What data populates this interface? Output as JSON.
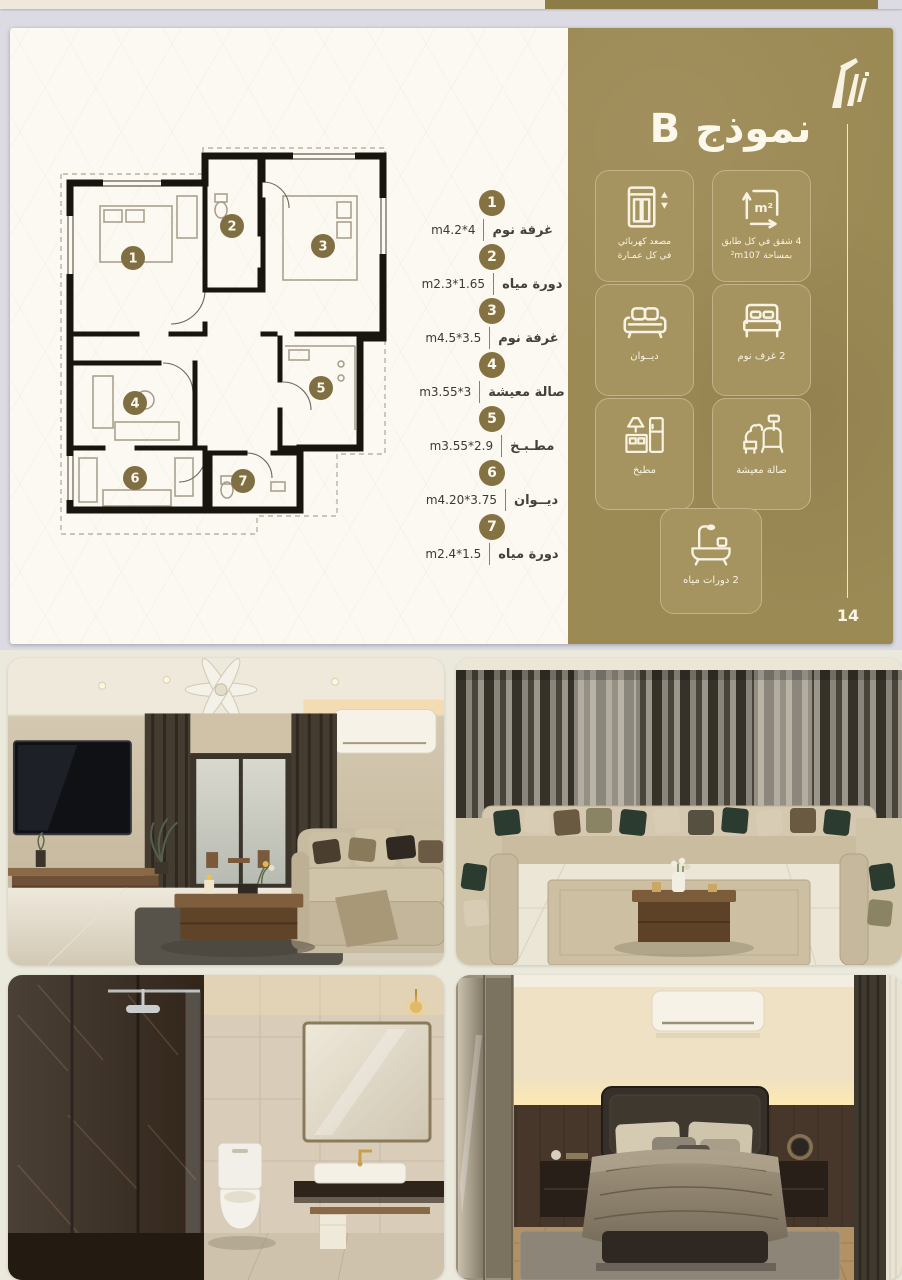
{
  "meta": {
    "page_number": "14"
  },
  "model": {
    "title": "نموذج B"
  },
  "legend": {
    "items": [
      {
        "num": "1",
        "name": "غرفة نوم",
        "dim": "m4.2*4"
      },
      {
        "num": "2",
        "name": "دورة مياه",
        "dim": "m2.3*1.65"
      },
      {
        "num": "3",
        "name": "غرفة نوم",
        "dim": "m4.5*3.5"
      },
      {
        "num": "4",
        "name": "صالة معيشة",
        "dim": "m3.55*3"
      },
      {
        "num": "5",
        "name": "مطـبـخ",
        "dim": "m3.55*2.9"
      },
      {
        "num": "6",
        "name": "ديــوان",
        "dim": "m4.20*3.75"
      },
      {
        "num": "7",
        "name": "دورة مياه",
        "dim": "m2.4*1.5"
      }
    ]
  },
  "features": {
    "elevator": {
      "line1": "مصعد كهربائي",
      "line2": "في كل عمـارة"
    },
    "area": {
      "line1": "4 شقق في كل طابق",
      "line2_prefix": "بمساحة",
      "line2_value": "²m107"
    },
    "diwan": {
      "label": "ديــوان"
    },
    "bedrooms": {
      "label": "2 غرف نوم"
    },
    "kitchen": {
      "label": "مطبخ"
    },
    "living": {
      "label": "صالة معيشة"
    },
    "bathrooms": {
      "label": "2 دورات مياه"
    }
  },
  "floor_plan": {
    "room_numbers": [
      "1",
      "2",
      "3",
      "4",
      "5",
      "6",
      "7"
    ]
  },
  "colors": {
    "panel_gold": "#9c8a55",
    "badge_olive": "#847243",
    "card_cream": "#fbf9f2",
    "page_bg": "#dcdbe4",
    "photo_bg": "#ebe8dc"
  },
  "photos": [
    {
      "name": "living-room"
    },
    {
      "name": "majlis-seating"
    },
    {
      "name": "bathroom"
    },
    {
      "name": "bedroom"
    }
  ]
}
